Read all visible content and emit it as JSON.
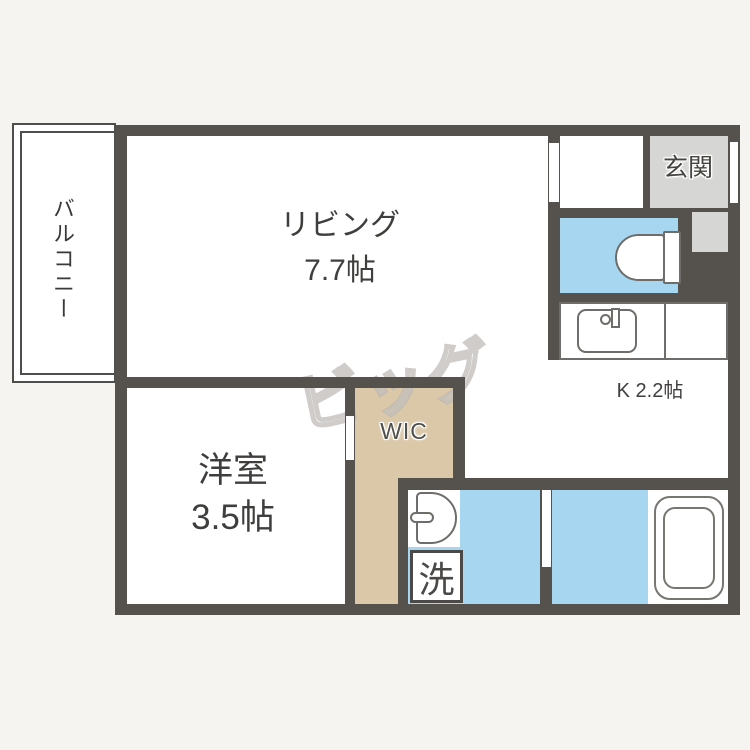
{
  "floorplan": {
    "watermark_text": "ビッグ",
    "balcony": {
      "label": "バルコニー"
    },
    "living": {
      "label": "リビング",
      "size": "7.7帖"
    },
    "western_room": {
      "label": "洋室",
      "size": "3.5帖"
    },
    "kitchen": {
      "label": "K 2.2帖"
    },
    "entrance": {
      "label": "玄関"
    },
    "walk_in_closet": {
      "label": "WIC"
    },
    "laundry": {
      "label": "洗"
    },
    "icons": {
      "toilet": "toilet-icon",
      "kitchen_sink": "kitchen-sink-icon",
      "washbasin": "washbasin-icon",
      "bathtub": "bathtub-icon",
      "washing_machine": "washing-machine-box"
    },
    "colors": {
      "wall": "#55524e",
      "water_rooms": "#a7d7f0",
      "closet": "#dac8a8",
      "entrance_floor": "#d6d6d4",
      "background": "#f5f4f1"
    }
  }
}
